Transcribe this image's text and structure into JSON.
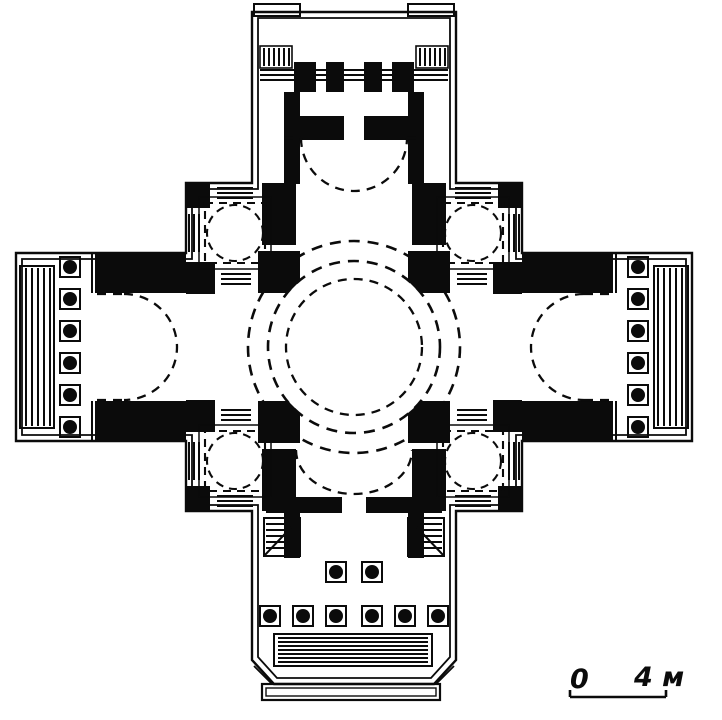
{
  "figure": {
    "kind": "architectural-floor-plan",
    "subject": "Greek-cross domed building plan, ink line drawing",
    "dome_projection_style": "dashed circles and arcs"
  },
  "plan": {
    "central_dome_dashed_circles": 3,
    "corner_chambers_with_dashed_domes": 4,
    "crossing_piers": 4,
    "west_portico": {
      "columns": 6,
      "has_side_steps": true
    },
    "east_portico": {
      "columns": 6,
      "has_side_steps": true
    },
    "north_porch": {
      "antae_blocks": 2,
      "pronaos_piers": 4
    },
    "south_portico": {
      "inner_columns": 2,
      "outer_columns": 6,
      "internal_stairs": 2,
      "front_steps": true
    }
  },
  "scale_bar": {
    "zero_label": "0",
    "length_label": "4 м"
  },
  "colors": {
    "ink": "#0b0b0b",
    "paper": "#ffffff"
  }
}
